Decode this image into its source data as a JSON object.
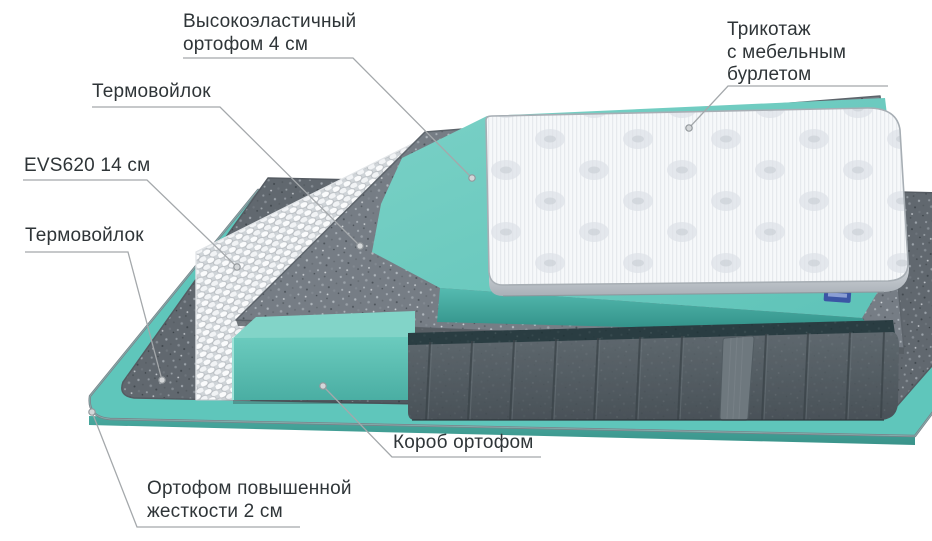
{
  "diagram": {
    "labels": {
      "elastic_foam": {
        "line1": "Высокоэластичный",
        "line2": "ортофом 4 см"
      },
      "thermofelt_top": {
        "text": "Термовойлок"
      },
      "springs": {
        "text": "EVS620 14 см"
      },
      "thermofelt_bottom": {
        "text": "Термовойлок"
      },
      "knit_cover": {
        "line1": "Трикотаж",
        "line2": "с мебельным",
        "line3": "бурлетом"
      },
      "foam_box": {
        "text": "Короб ортофом"
      },
      "rigid_foam": {
        "line1": "Ортофом повышенной",
        "line2": "жесткости 2 см"
      }
    },
    "layers": [
      "Трикотаж с мебельным бурлетом",
      "Высокоэластичный ортофом 4 см",
      "Термовойлок",
      "EVS620 14 см",
      "Короб ортофом",
      "Термовойлок",
      "Ортофом повышенной жесткости 2 см"
    ]
  },
  "colors": {
    "text-color": "#2f3538",
    "leader-color": "#a4a8ab",
    "foam-teal": "#5fc6bb",
    "foam-teal-dark": "#3f9d94",
    "felt-gray": "#61686f",
    "felt-gray-light": "#767d85",
    "base-gray": "#525c62",
    "binding-dark": "#1b3135",
    "quilt-white": "#f7f8fa",
    "tag-blue": "#3b55a5"
  }
}
